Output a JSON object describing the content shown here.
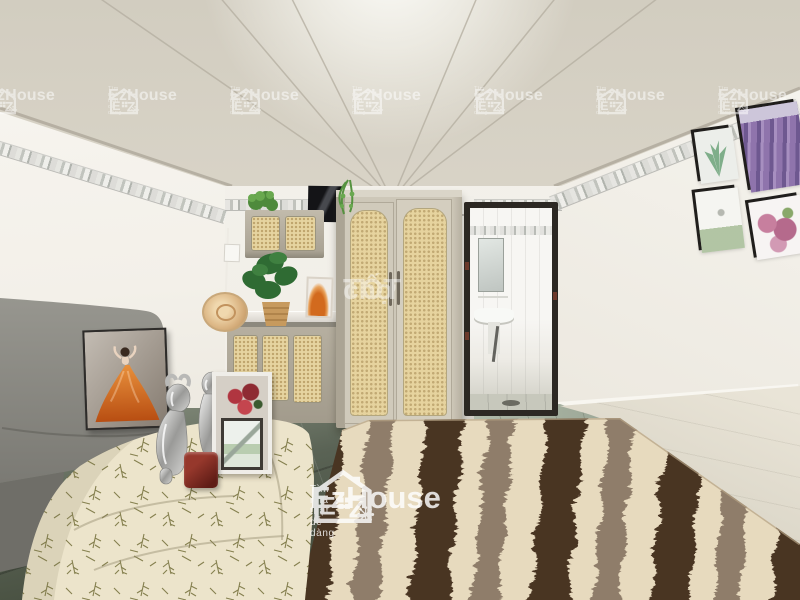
{
  "meta": {
    "description": "Interior photo of a bright studio apartment: rattan wardrobe, kitchenette with cane cabinets, bathroom doorway, gray sofa with orange dress artwork, leaf-print covered bed, chrome figurines and a brown-cream wavy shag rug",
    "photo_type": "real-estate listing photo"
  },
  "watermarks": {
    "ezhouse": {
      "brand": "EzHouse",
      "tagline": "Tìm nhà thật dễ dàng",
      "logo_letter_e": "E",
      "logo_letter_z": "Z",
      "color": "#ffffff",
      "top_row_count": 7
    },
    "chotot": {
      "prefix": "chợ",
      "suffix": "TỐT",
      "color": "#ffffff"
    }
  },
  "palette": {
    "ceiling": "#d8d3c7",
    "walls": "#f3f1ea",
    "rattan": "#e6d4a0",
    "wardrobe_frame": "#cdc7b8",
    "sofa_gray": "#8d8c89",
    "rug_cream": "#e7dabe",
    "rug_brown": "#4a3424",
    "rug_taupe": "#8f7d6a",
    "bed_cloth": "#ece4cb",
    "floor_dark": "#4e574c",
    "floor_light": "#dcd7c9",
    "artwork_orange": "#d2691e",
    "door_frame": "#2c2823"
  }
}
